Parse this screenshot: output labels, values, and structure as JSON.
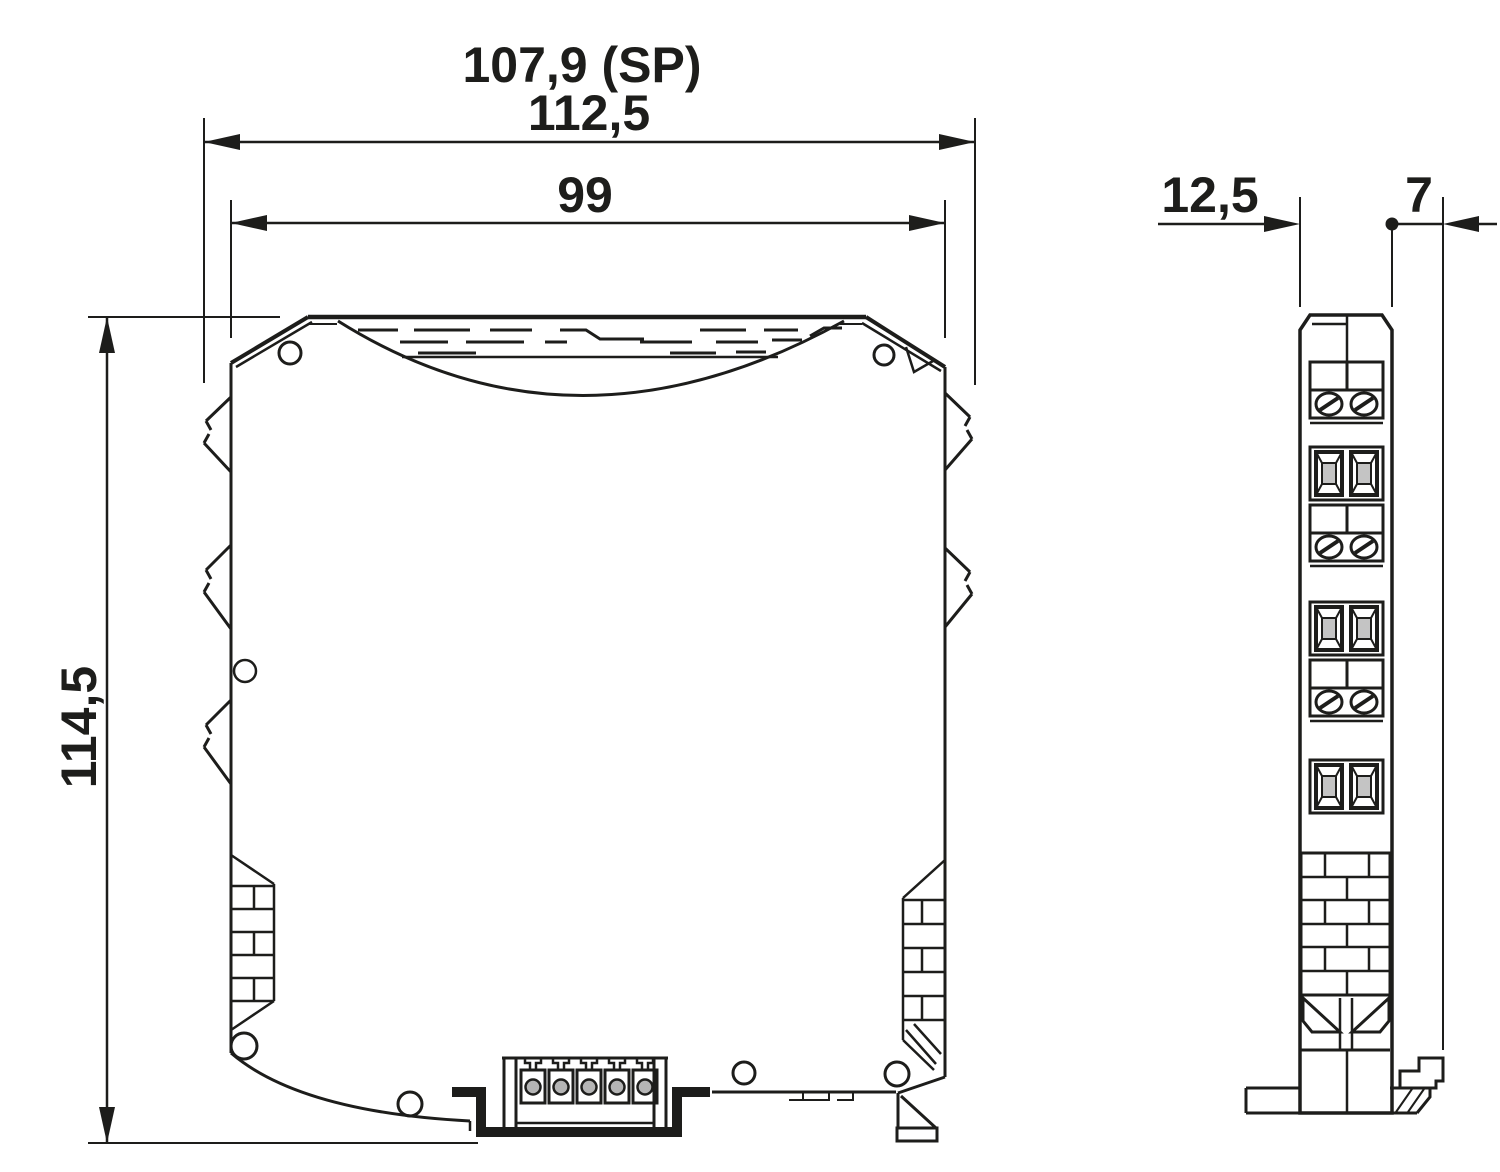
{
  "drawing": {
    "front_view": {
      "dim_snap_pitch": "107,9 (SP)",
      "dim_overall_width": "112,5",
      "dim_housing_width": "99",
      "dim_height": "114,5"
    },
    "side_view": {
      "dim_width": "12,5",
      "dim_rear_depth": "7"
    },
    "line_color": "#1d1d1b"
  }
}
